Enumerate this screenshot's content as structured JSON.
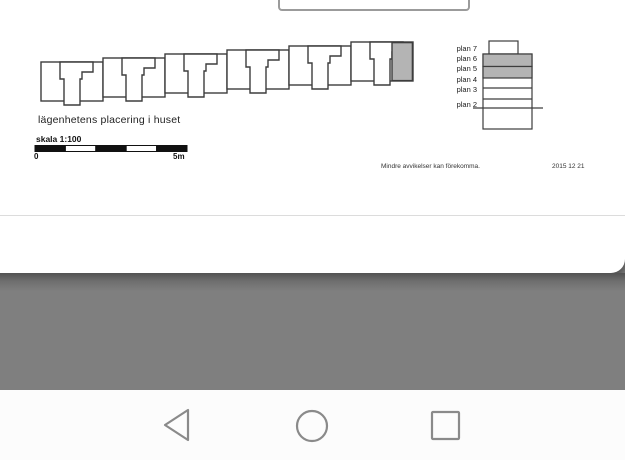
{
  "document": {
    "caption": "lägenhetens placering i huset",
    "scale": {
      "label": "skala 1:100",
      "start": "0",
      "end": "5m"
    },
    "floors": [
      {
        "label": "plan 7"
      },
      {
        "label": "plan 6"
      },
      {
        "label": "plan 5"
      },
      {
        "label": "plan 4"
      },
      {
        "label": "plan 3"
      },
      {
        "label": "plan 2"
      }
    ],
    "highlighted_floors": "plan 6, plan 5",
    "note": "Mindre avvikelser kan förekomma.",
    "date": "2015 12 21",
    "colors": {
      "apartment_highlight": "#b4b4b4",
      "drawing_line": "#3d3d3d",
      "scale_bar_fill": "#111111"
    }
  },
  "navbar": {
    "icon_color": "#8a8a8a",
    "back_icon": "back-triangle",
    "home_icon": "home-circle",
    "recents_icon": "recents-square"
  }
}
